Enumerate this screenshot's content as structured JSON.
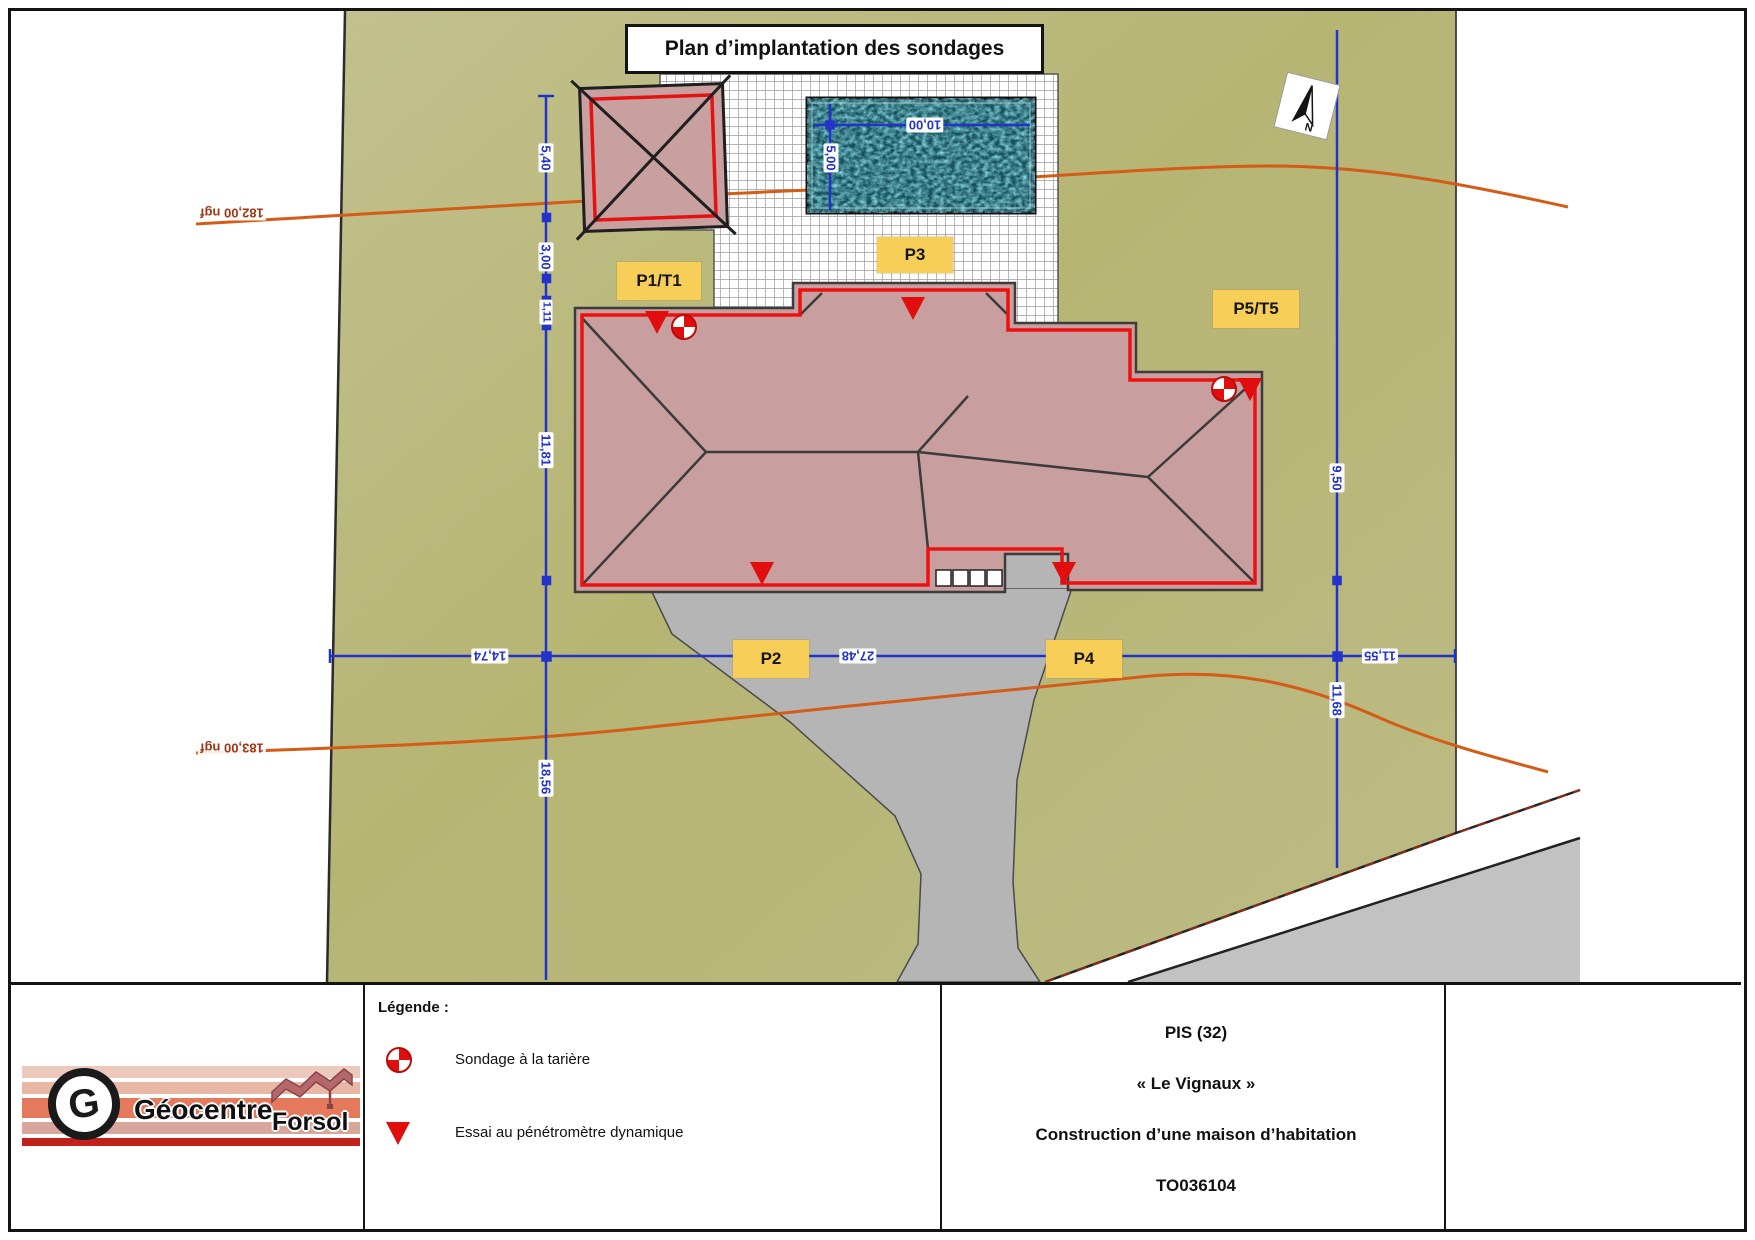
{
  "page_title": "Plan d’implantation des sondages",
  "map": {
    "north_letter": "N",
    "labels": {
      "p1t1": "P1/T1",
      "p3": "P3",
      "p5t5": "P5/T5",
      "p2": "P2",
      "p4": "P4"
    },
    "dims": {
      "left1": "5,40",
      "left2": "3,00",
      "left3": "1,11",
      "left4": "11,81",
      "left5": "18,56",
      "bottom1": "14,74",
      "bottom2": "27,48",
      "bottom3": "11,55",
      "right1": "9,50",
      "right2": "11,68",
      "pool_w": "10,00",
      "pool_h": "5,00"
    },
    "contours": {
      "upper": "182,00 ngf",
      "lower": "183,00 ngf"
    }
  },
  "legend": {
    "heading": "Légende :",
    "tariere": "Sondage à la tarière",
    "penetrometre": "Essai au pénétromètre dynamique"
  },
  "title_block": {
    "line1": "PIS (32)",
    "line2": "« Le Vignaux »",
    "line3": "Construction d’une maison d’habitation",
    "line4": "TO036104"
  },
  "logo": {
    "monogram": "G",
    "geocentre": "Géocentre",
    "forsol": "Forsol"
  }
}
